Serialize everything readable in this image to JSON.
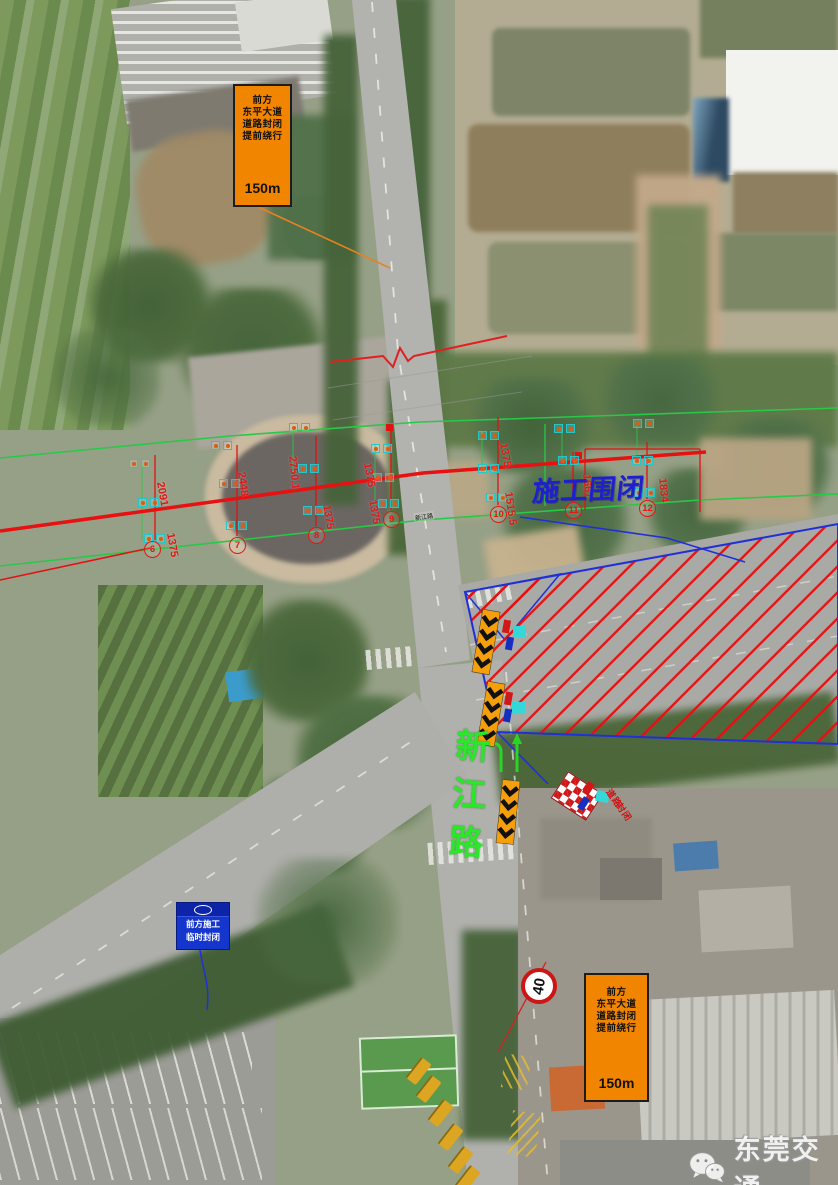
{
  "meta": {
    "watermark": "东莞交通",
    "watermark_icon": "wechat-icon"
  },
  "labels": {
    "construction_closure": "施工围闭",
    "road_name_vertical": "新江路",
    "road_name_small": "新江路",
    "barrier_text_col1": "道路",
    "barrier_text_col2": "封闭"
  },
  "signs": {
    "closure_ahead": {
      "lines": [
        "前方",
        "东平大道",
        "道路封闭",
        "提前绕行"
      ],
      "distance": "150m"
    },
    "blue_notice": {
      "lines": [
        "前方施工",
        "临时封闭"
      ]
    },
    "speed_limit": {
      "value": "40"
    }
  },
  "annotations": {
    "dimensions": [
      {
        "value": "2091",
        "x": 160,
        "y": 476,
        "rot": 80
      },
      {
        "value": "1375",
        "x": 170,
        "y": 527,
        "rot": 80
      },
      {
        "value": "2448",
        "x": 241,
        "y": 466,
        "rot": 82
      },
      {
        "value": "2750.1",
        "x": 292,
        "y": 450,
        "rot": 84
      },
      {
        "value": "1375",
        "x": 326,
        "y": 499,
        "rot": 80
      },
      {
        "value": "1375",
        "x": 367,
        "y": 457,
        "rot": 80
      },
      {
        "value": "1375",
        "x": 372,
        "y": 494,
        "rot": 80
      },
      {
        "value": "1375",
        "x": 503,
        "y": 437,
        "rot": 80
      },
      {
        "value": "1515.5",
        "x": 508,
        "y": 486,
        "rot": 82
      },
      {
        "value": "1667",
        "x": 586,
        "y": 468,
        "rot": 84
      },
      {
        "value": "1834",
        "x": 662,
        "y": 472,
        "rot": 84
      }
    ],
    "point_numbers": [
      {
        "value": "6",
        "x": 152,
        "y": 549
      },
      {
        "value": "7",
        "x": 237,
        "y": 545
      },
      {
        "value": "8",
        "x": 316,
        "y": 535
      },
      {
        "value": "9",
        "x": 391,
        "y": 519
      },
      {
        "value": "10",
        "x": 498,
        "y": 514
      },
      {
        "value": "11",
        "x": 573,
        "y": 510
      },
      {
        "value": "12",
        "x": 647,
        "y": 508
      }
    ],
    "markers": [
      [
        133,
        463
      ],
      [
        145,
        463
      ],
      [
        215,
        445
      ],
      [
        227,
        445
      ],
      [
        223,
        483
      ],
      [
        235,
        483
      ],
      [
        142,
        502
      ],
      [
        154,
        502
      ],
      [
        230,
        525
      ],
      [
        242,
        525
      ],
      [
        148,
        538
      ],
      [
        160,
        538
      ],
      [
        293,
        427
      ],
      [
        305,
        427
      ],
      [
        302,
        468
      ],
      [
        314,
        468
      ],
      [
        307,
        510
      ],
      [
        319,
        510
      ],
      [
        375,
        448
      ],
      [
        387,
        448
      ],
      [
        377,
        477
      ],
      [
        389,
        477
      ],
      [
        382,
        503
      ],
      [
        394,
        503
      ],
      [
        482,
        435
      ],
      [
        494,
        435
      ],
      [
        558,
        428
      ],
      [
        570,
        428
      ],
      [
        637,
        423
      ],
      [
        649,
        423
      ],
      [
        482,
        468
      ],
      [
        494,
        468
      ],
      [
        562,
        460
      ],
      [
        574,
        460
      ],
      [
        636,
        460
      ],
      [
        648,
        460
      ],
      [
        490,
        497
      ],
      [
        502,
        497
      ],
      [
        638,
        492
      ],
      [
        650,
        492
      ]
    ]
  },
  "colors": {
    "dimension_red": "#e01818",
    "survey_green": "#28c848",
    "closure_text_blue": "#1f1fd0",
    "road_label_green": "#2ce62c",
    "sign_orange": "#f28500",
    "sign_blue": "#1536cc",
    "hatch_red": "#e01212",
    "boundary_blue": "#2030d8",
    "speed_ring_red": "#cc1515"
  }
}
